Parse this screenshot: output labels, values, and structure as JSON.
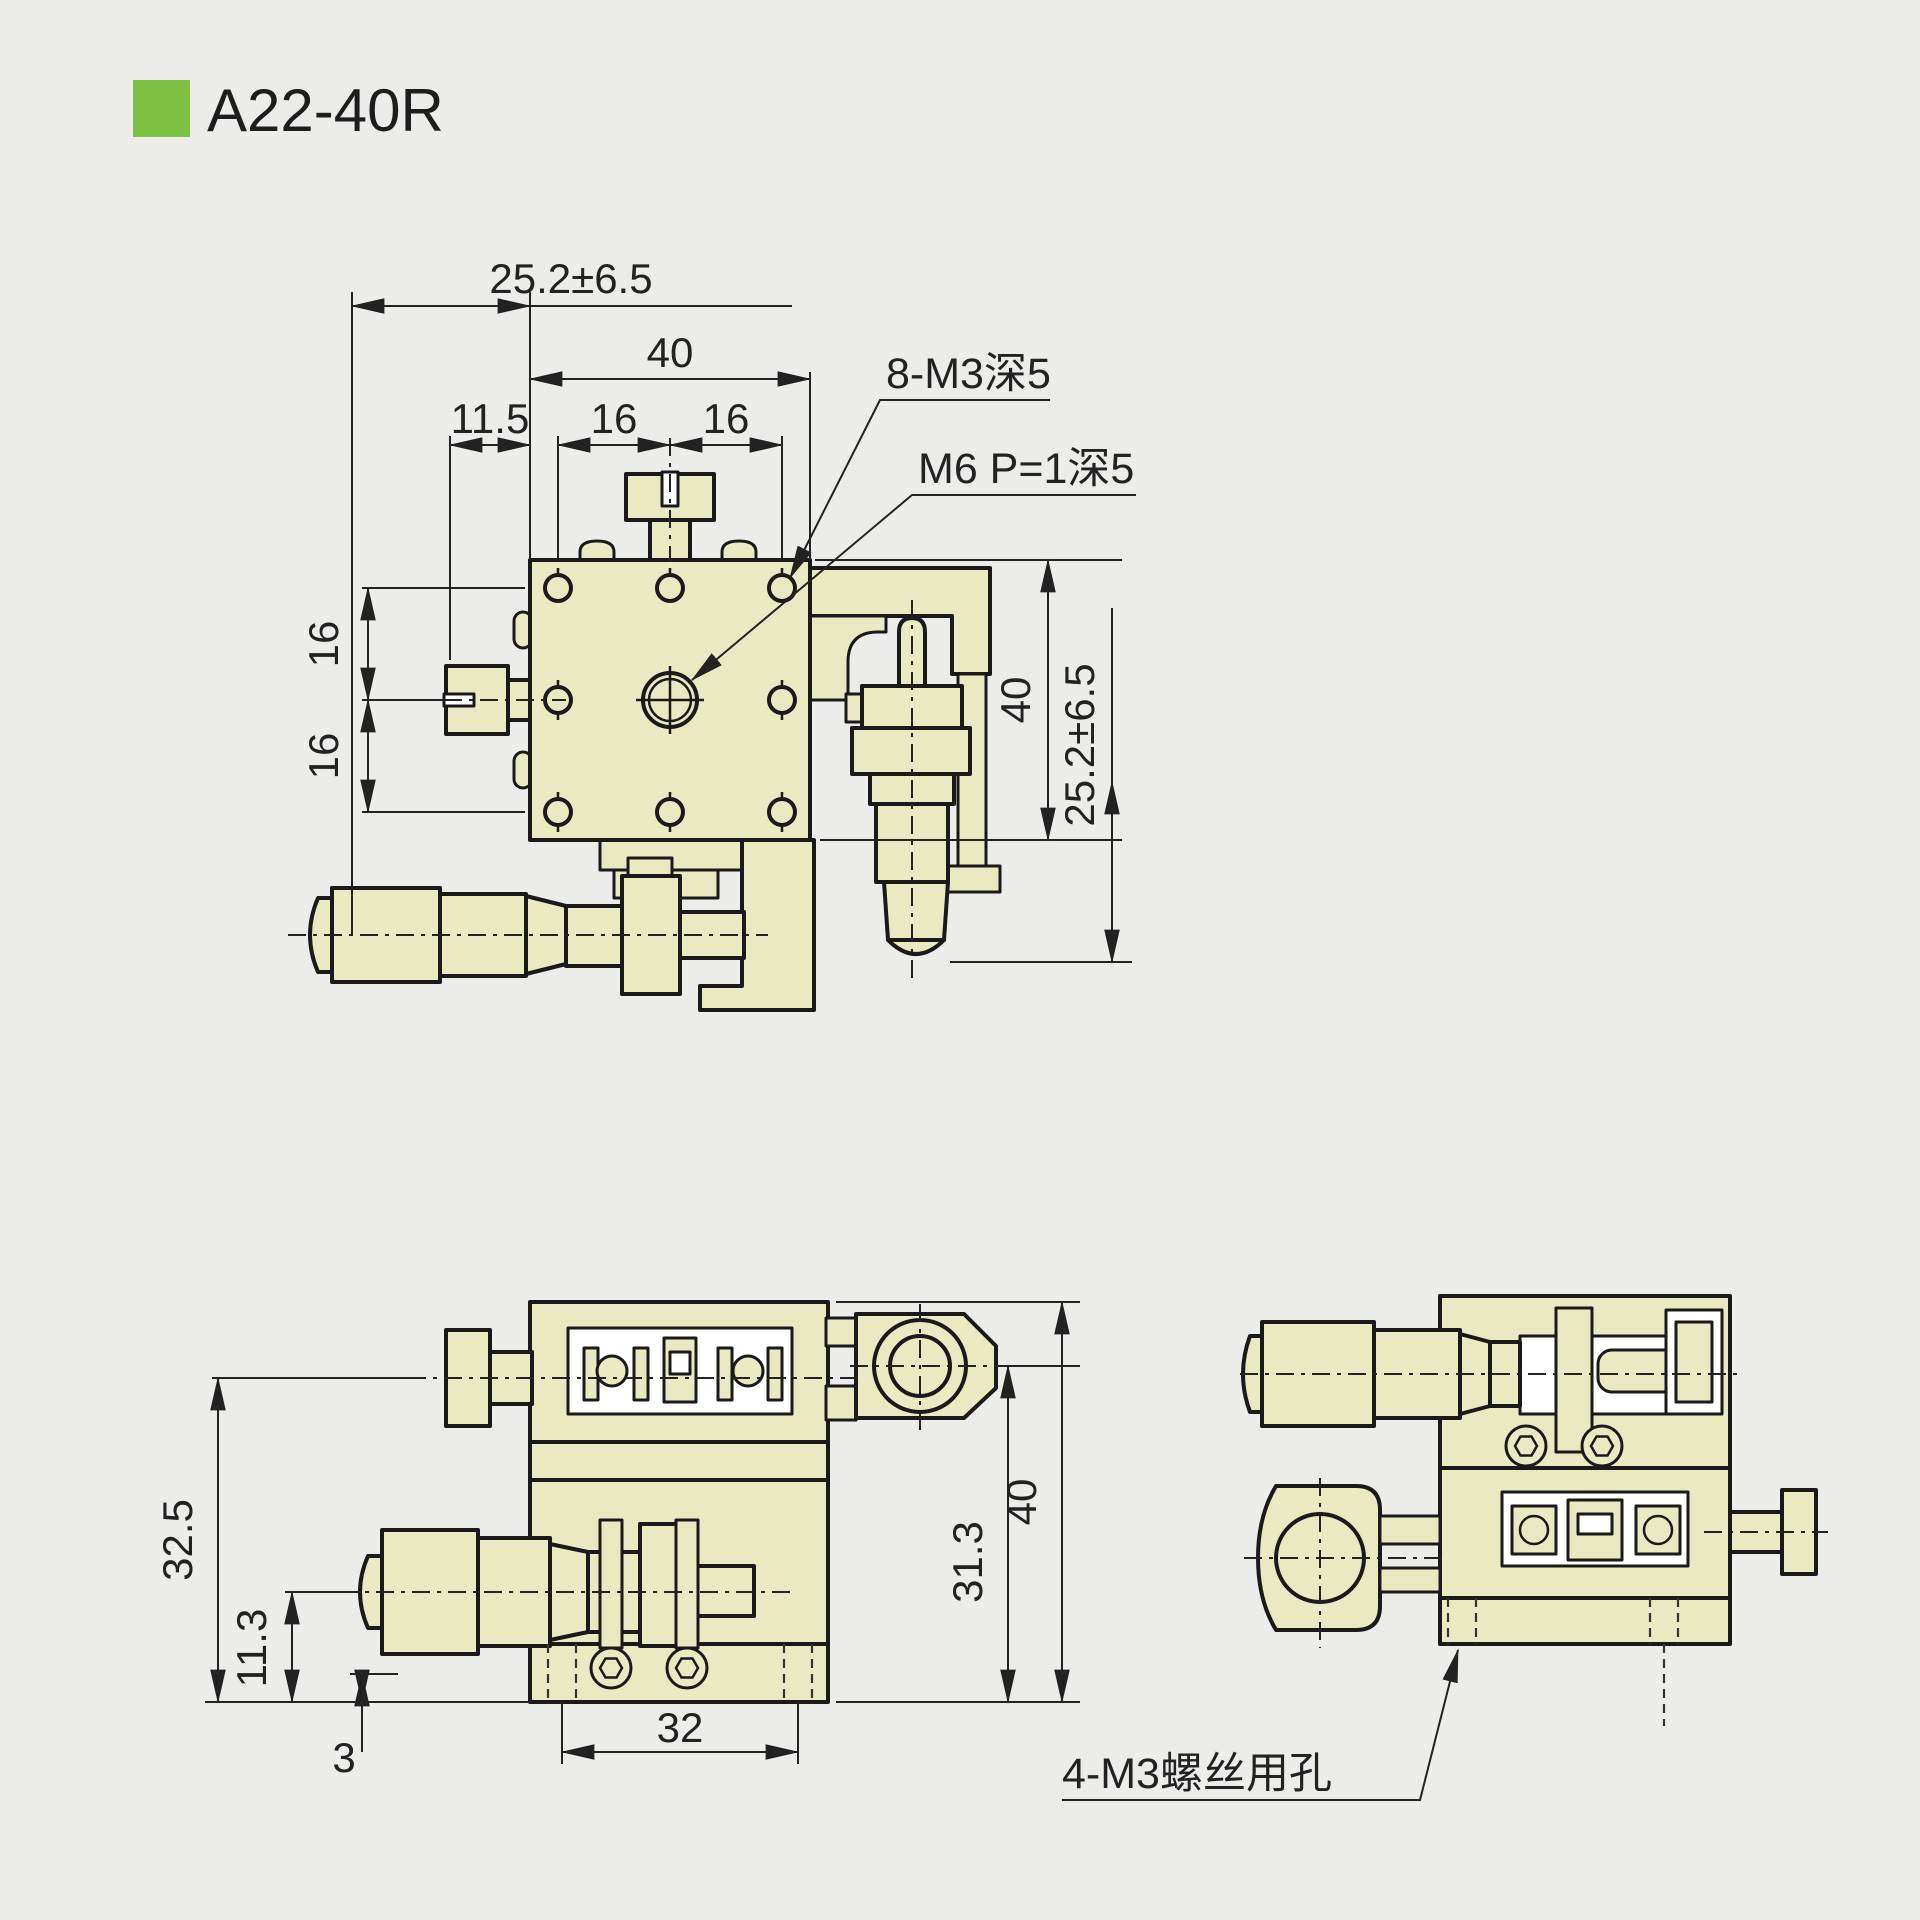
{
  "page": {
    "background": "#ECECEA"
  },
  "title": {
    "code": "A22-40R",
    "accent_color": "#7CC142"
  },
  "drawing": {
    "body_fill": "#EAEAC2",
    "line_color": "#1a1a1a",
    "front_view": {
      "dim_travel_horizontal": "25.2±6.5",
      "dim_width": "40",
      "dim_offset": "11.5",
      "dim_pitch_h1": "16",
      "dim_pitch_h2": "16",
      "dim_pitch_v1": "16",
      "dim_pitch_v2": "16",
      "dim_height": "40",
      "dim_travel_vertical": "25.2±6.5",
      "label_tapped_holes": "8-M3深5",
      "label_center_thread": "M6 P=1深5"
    },
    "bottom_view": {
      "dim_height_total": "32.5",
      "dim_axis_height": "11.3",
      "dim_base_step": "3",
      "dim_hole_span": "32",
      "dim_height_upper": "31.3",
      "dim_height_overall": "40"
    },
    "side_view": {
      "label_mount_holes": "4-M3螺丝用孔"
    }
  }
}
